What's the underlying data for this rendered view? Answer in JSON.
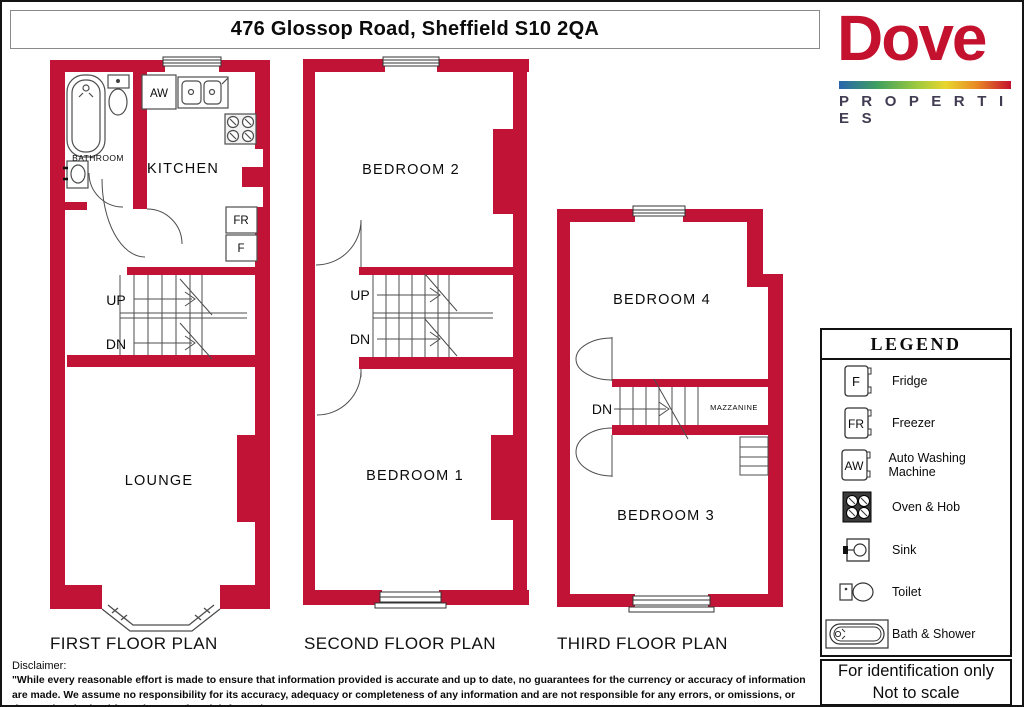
{
  "title": "476 Glossop Road, Sheffield S10 2QA",
  "logo": {
    "name": "Dove",
    "subtitle": "P R O P E R T I E S"
  },
  "colors": {
    "wall": "#C11335",
    "logo_red": "#C4112E",
    "logo_dark": "#413C52"
  },
  "plans": {
    "first": {
      "label": "FIRST FLOOR PLAN",
      "rooms": {
        "bathroom": "BATHROOM",
        "kitchen": "KITCHEN",
        "lounge": "LOUNGE"
      },
      "stairs": {
        "up": "UP",
        "dn": "DN"
      },
      "appliances": {
        "aw": "AW",
        "fr": "FR",
        "f": "F"
      }
    },
    "second": {
      "label": "SECOND FLOOR PLAN",
      "rooms": {
        "bedroom2": "BEDROOM 2",
        "bedroom1": "BEDROOM 1"
      },
      "stairs": {
        "up": "UP",
        "dn": "DN"
      }
    },
    "third": {
      "label": "THIRD FLOOR PLAN",
      "rooms": {
        "bedroom4": "BEDROOM 4",
        "bedroom3": "BEDROOM 3",
        "mazzanine": "MAZZANINE"
      },
      "stairs": {
        "dn": "DN"
      }
    }
  },
  "legend": {
    "title": "LEGEND",
    "items": [
      {
        "symbol": "F",
        "label": "Fridge"
      },
      {
        "symbol": "FR",
        "label": "Freezer"
      },
      {
        "symbol": "AW",
        "label": "Auto Washing Machine"
      },
      {
        "label": "Oven & Hob"
      },
      {
        "label": "Sink"
      },
      {
        "label": "Toilet"
      },
      {
        "label": "Bath & Shower"
      }
    ]
  },
  "footer_box": {
    "line1": "For identification only",
    "line2": "Not to scale"
  },
  "disclaimer": {
    "heading": "Disclaimer:",
    "text": "\"While every reasonable effort is made to ensure that information provided is accurate and up to date, no guarantees for the currency or accuracy of information are made. We assume no responsibility for its accuracy, adequacy or completeness of any information and are not responsible for any errors, or omissions, or the results obtained from the use of such information.\""
  }
}
